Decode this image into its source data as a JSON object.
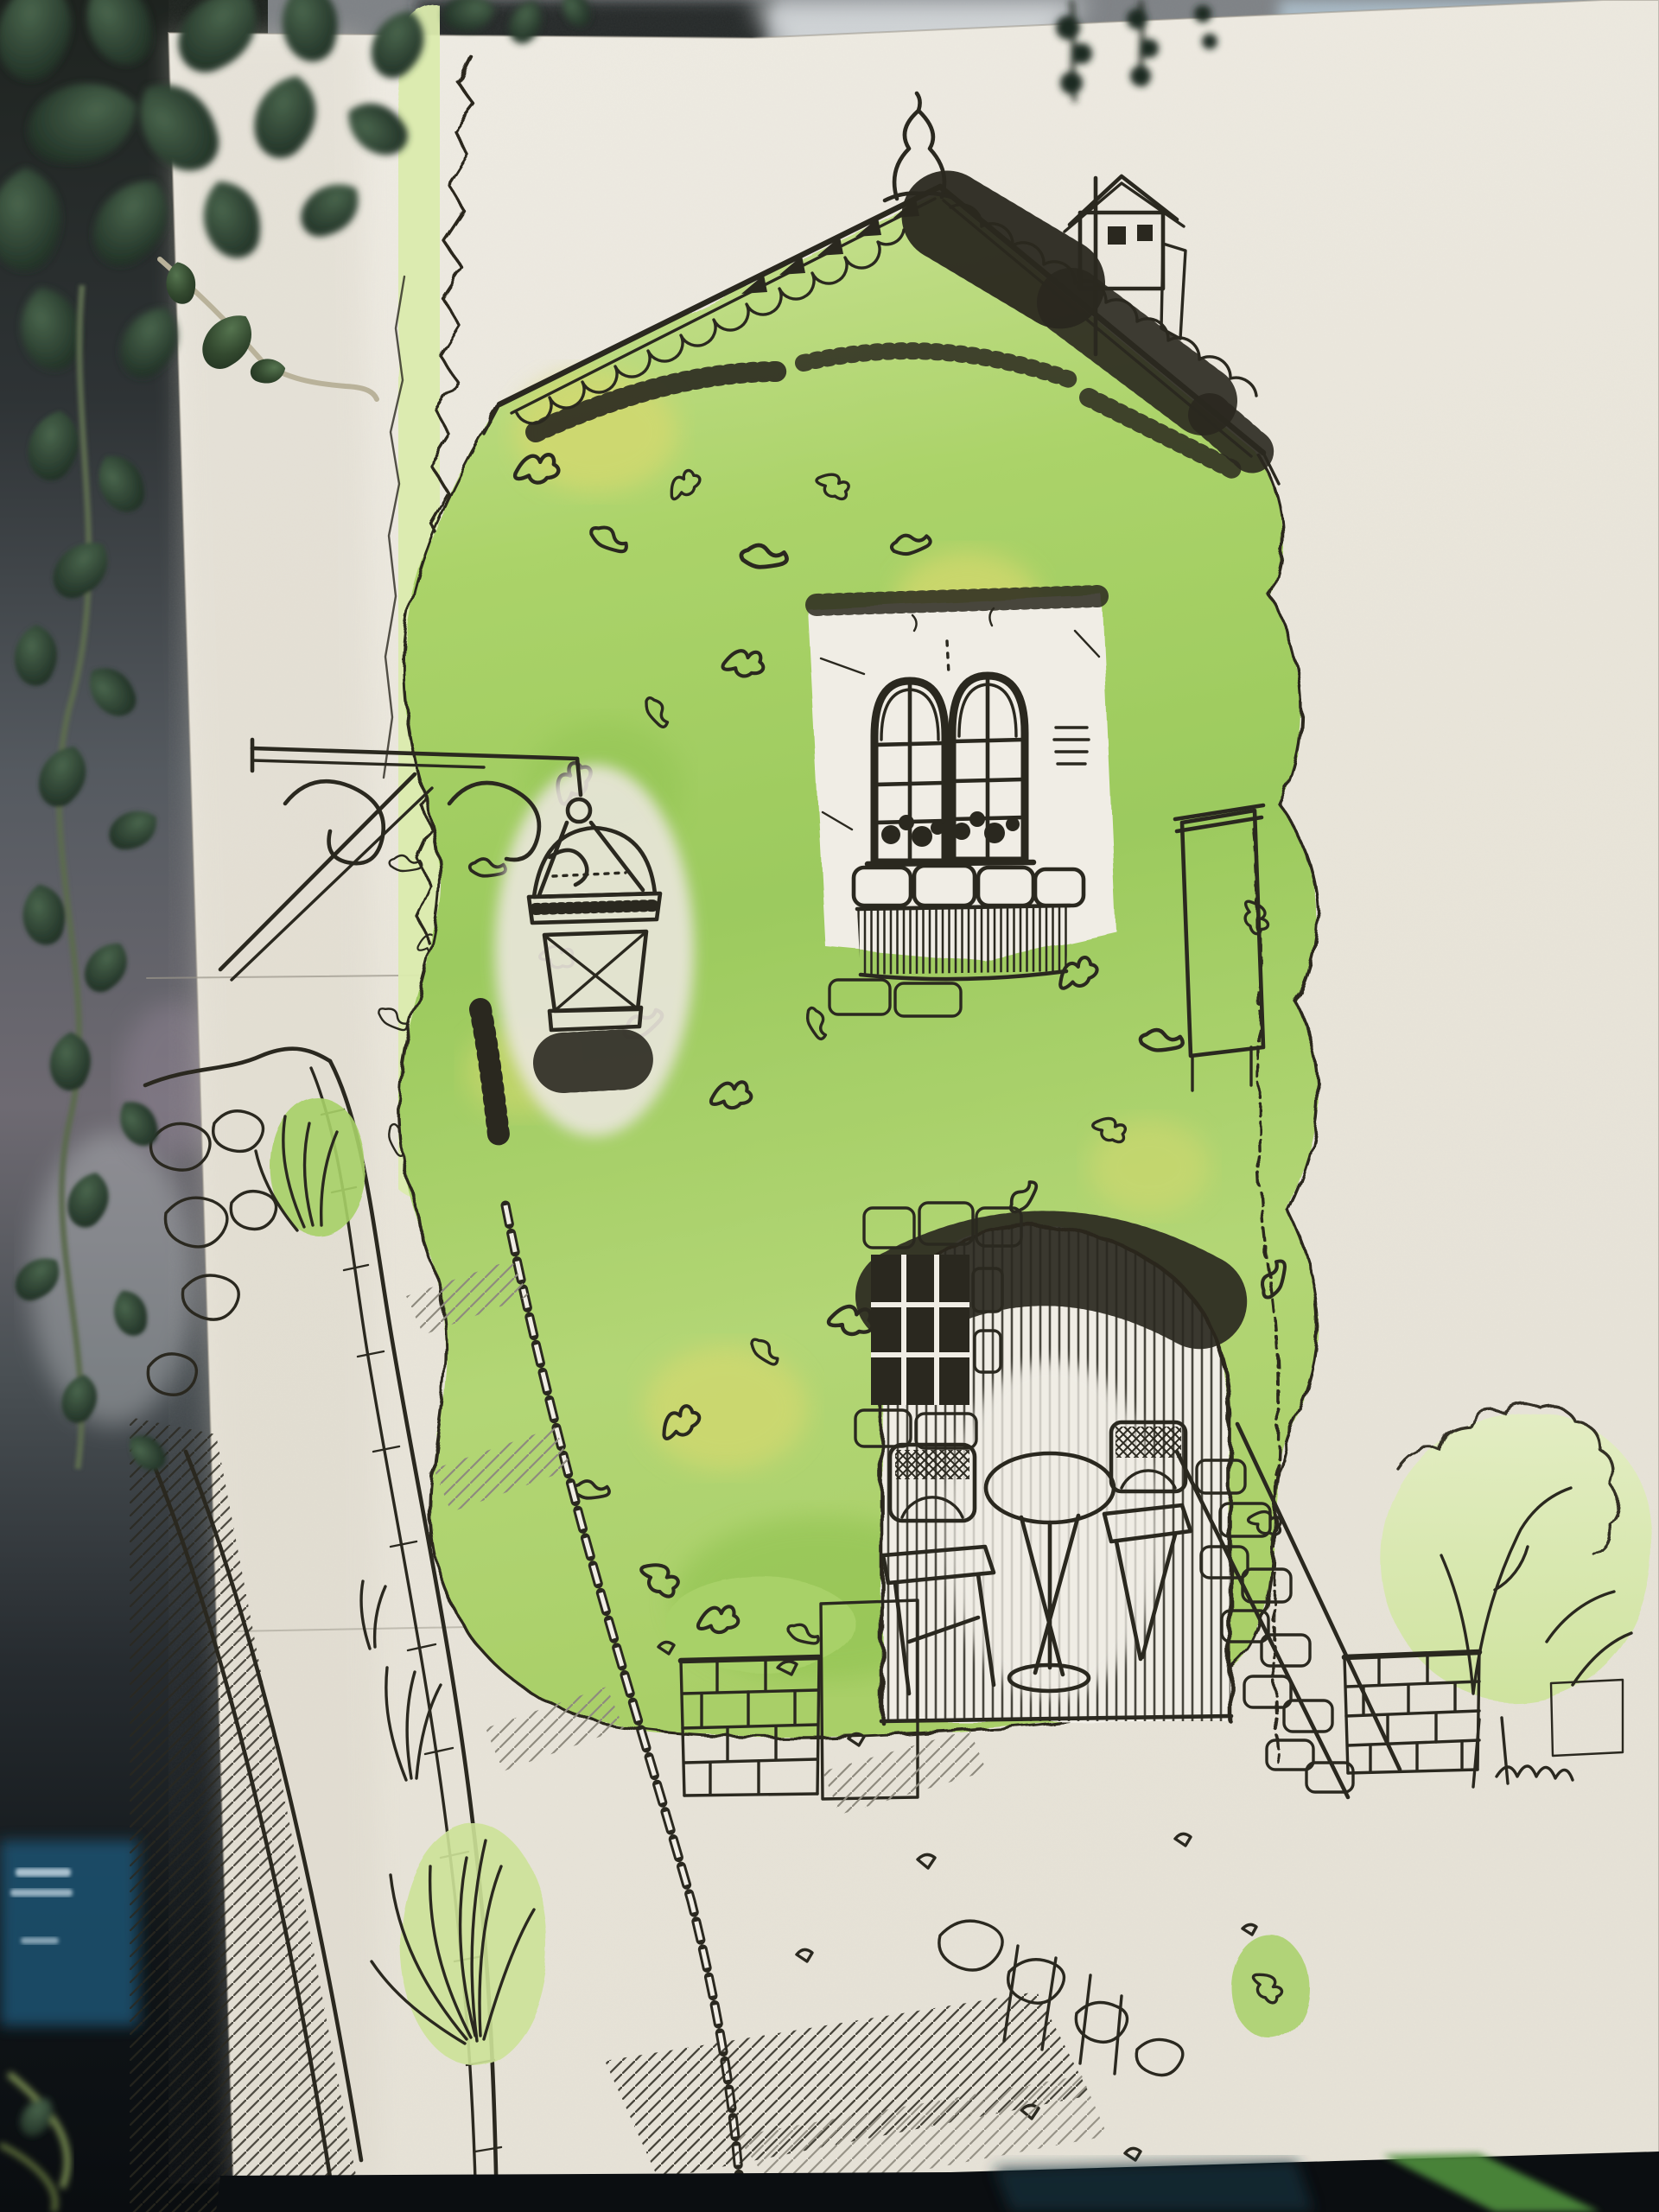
{
  "image": {
    "type": "photograph of artwork",
    "subject": "Pen-and-ink and watercolor sketch of an ivy-covered stone house on a sloping cobbled lane",
    "context": "textured watercolor paper propped against window glass with a dark hanging succulent plant draped over the upper-left corner"
  },
  "palette": {
    "paper": "#eae6dc",
    "paper-hi": "#f0ede5",
    "ink": "#2a281f",
    "pencil": "#9a968a",
    "wash-pale": "#dcecae",
    "wash-light": "#cde398",
    "wash-mid": "#a8d167",
    "wash-deep": "#8fc24f",
    "wash-yellow": "#d8d96e",
    "glass-teal": "#a9c7bd",
    "glass-teal-dk": "#6f948c",
    "leaf-dark": "#1d2b20",
    "leaf-mid": "#33492f",
    "glass-bg": "#4c5257",
    "reflect-blue": "#1c5272",
    "band-dark": "#0b0e11",
    "stripe-green": "#4f8f3c",
    "top-grey": "#7e8286",
    "top-blue": "#a8bac6"
  },
  "sketch": {
    "subject": "ivy-covered house with street lantern and patio",
    "elements": [
      "gabled roof with scalloped tiles and dentils",
      "onion-shaped spire finial",
      "birdhouse chimney on a pole",
      "large ivy mass in green watercolor wash with yellow patches",
      "double arched window with teal glass and potted plants on the sill",
      "stone window sill and hatched ledge",
      "slatted shutter draped with ivy",
      "wrought-iron scroll bracket",
      "hanging street lantern with cross straps",
      "climbing vine with zigzag ink outline",
      "arched patio opening with vertical hatching",
      "lattice casement window framed in stones",
      "round bistro table with cross-hatched top",
      "two lattice-back chairs",
      "stone step ramp",
      "stone block pillar and slatted fence",
      "rocky retaining wall with hatching",
      "curving cobbled path with dashed curb chain",
      "grass tufts",
      "light-washed garden bush with twigs",
      "brick garden wall",
      "faint pencil guidelines"
    ]
  },
  "photo": {
    "elements": [
      "hanging succulent strands with round dark leaves",
      "blurred grey window reflections at top",
      "purple-grey glass reflection on the left",
      "blue reflection patch with illegible light marks",
      "dark shelf band at the bottom",
      "blurred green leaf reflection at bottom right"
    ]
  }
}
